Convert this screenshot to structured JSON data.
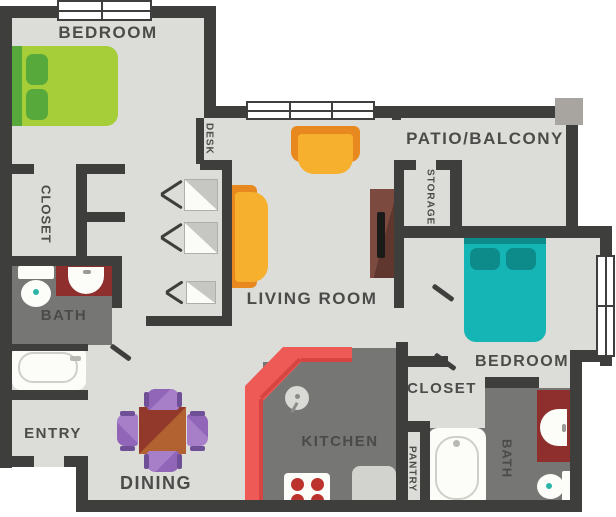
{
  "title": "Two Bedroom Apartment Floor Plan",
  "rooms": {
    "bedroom1": "BEDROOM",
    "closet1": "CLOSET",
    "desk": "DESK",
    "bath1": "BATH",
    "entry": "ENTRY",
    "dining": "DINING",
    "kitchen": "KITCHEN",
    "pantry": "PANTRY",
    "living_room": "LIVING ROOM",
    "patio": "PATIO/BALCONY",
    "storage": "STORAGE",
    "bedroom2": "BEDROOM",
    "closet2": "CLOSET",
    "bath2": "BATH"
  },
  "colors": {
    "wall": "#3e3e3c",
    "floor": "#dcdcd9",
    "floor_dark": "#767674",
    "label": "#4b4b49",
    "green": "#a6ce39",
    "green_dark": "#57a93c",
    "teal": "#14b5b4",
    "teal_dark": "#0d8b8a",
    "orange": "#f6b02e",
    "orange_dark": "#e8891f",
    "red": "#ee5a56",
    "red_dark": "#d64541",
    "maroon": "#8e2f2e",
    "purple": "#a77fc9",
    "purple_dark": "#6f4f96",
    "table_dark": "#93392b",
    "table_light": "#b26231",
    "console": "#74453a",
    "white_fixture": "#fcfcf9",
    "appliance": "#d2d2ce",
    "burner": "#bc332e",
    "column": "#a8a49f"
  }
}
